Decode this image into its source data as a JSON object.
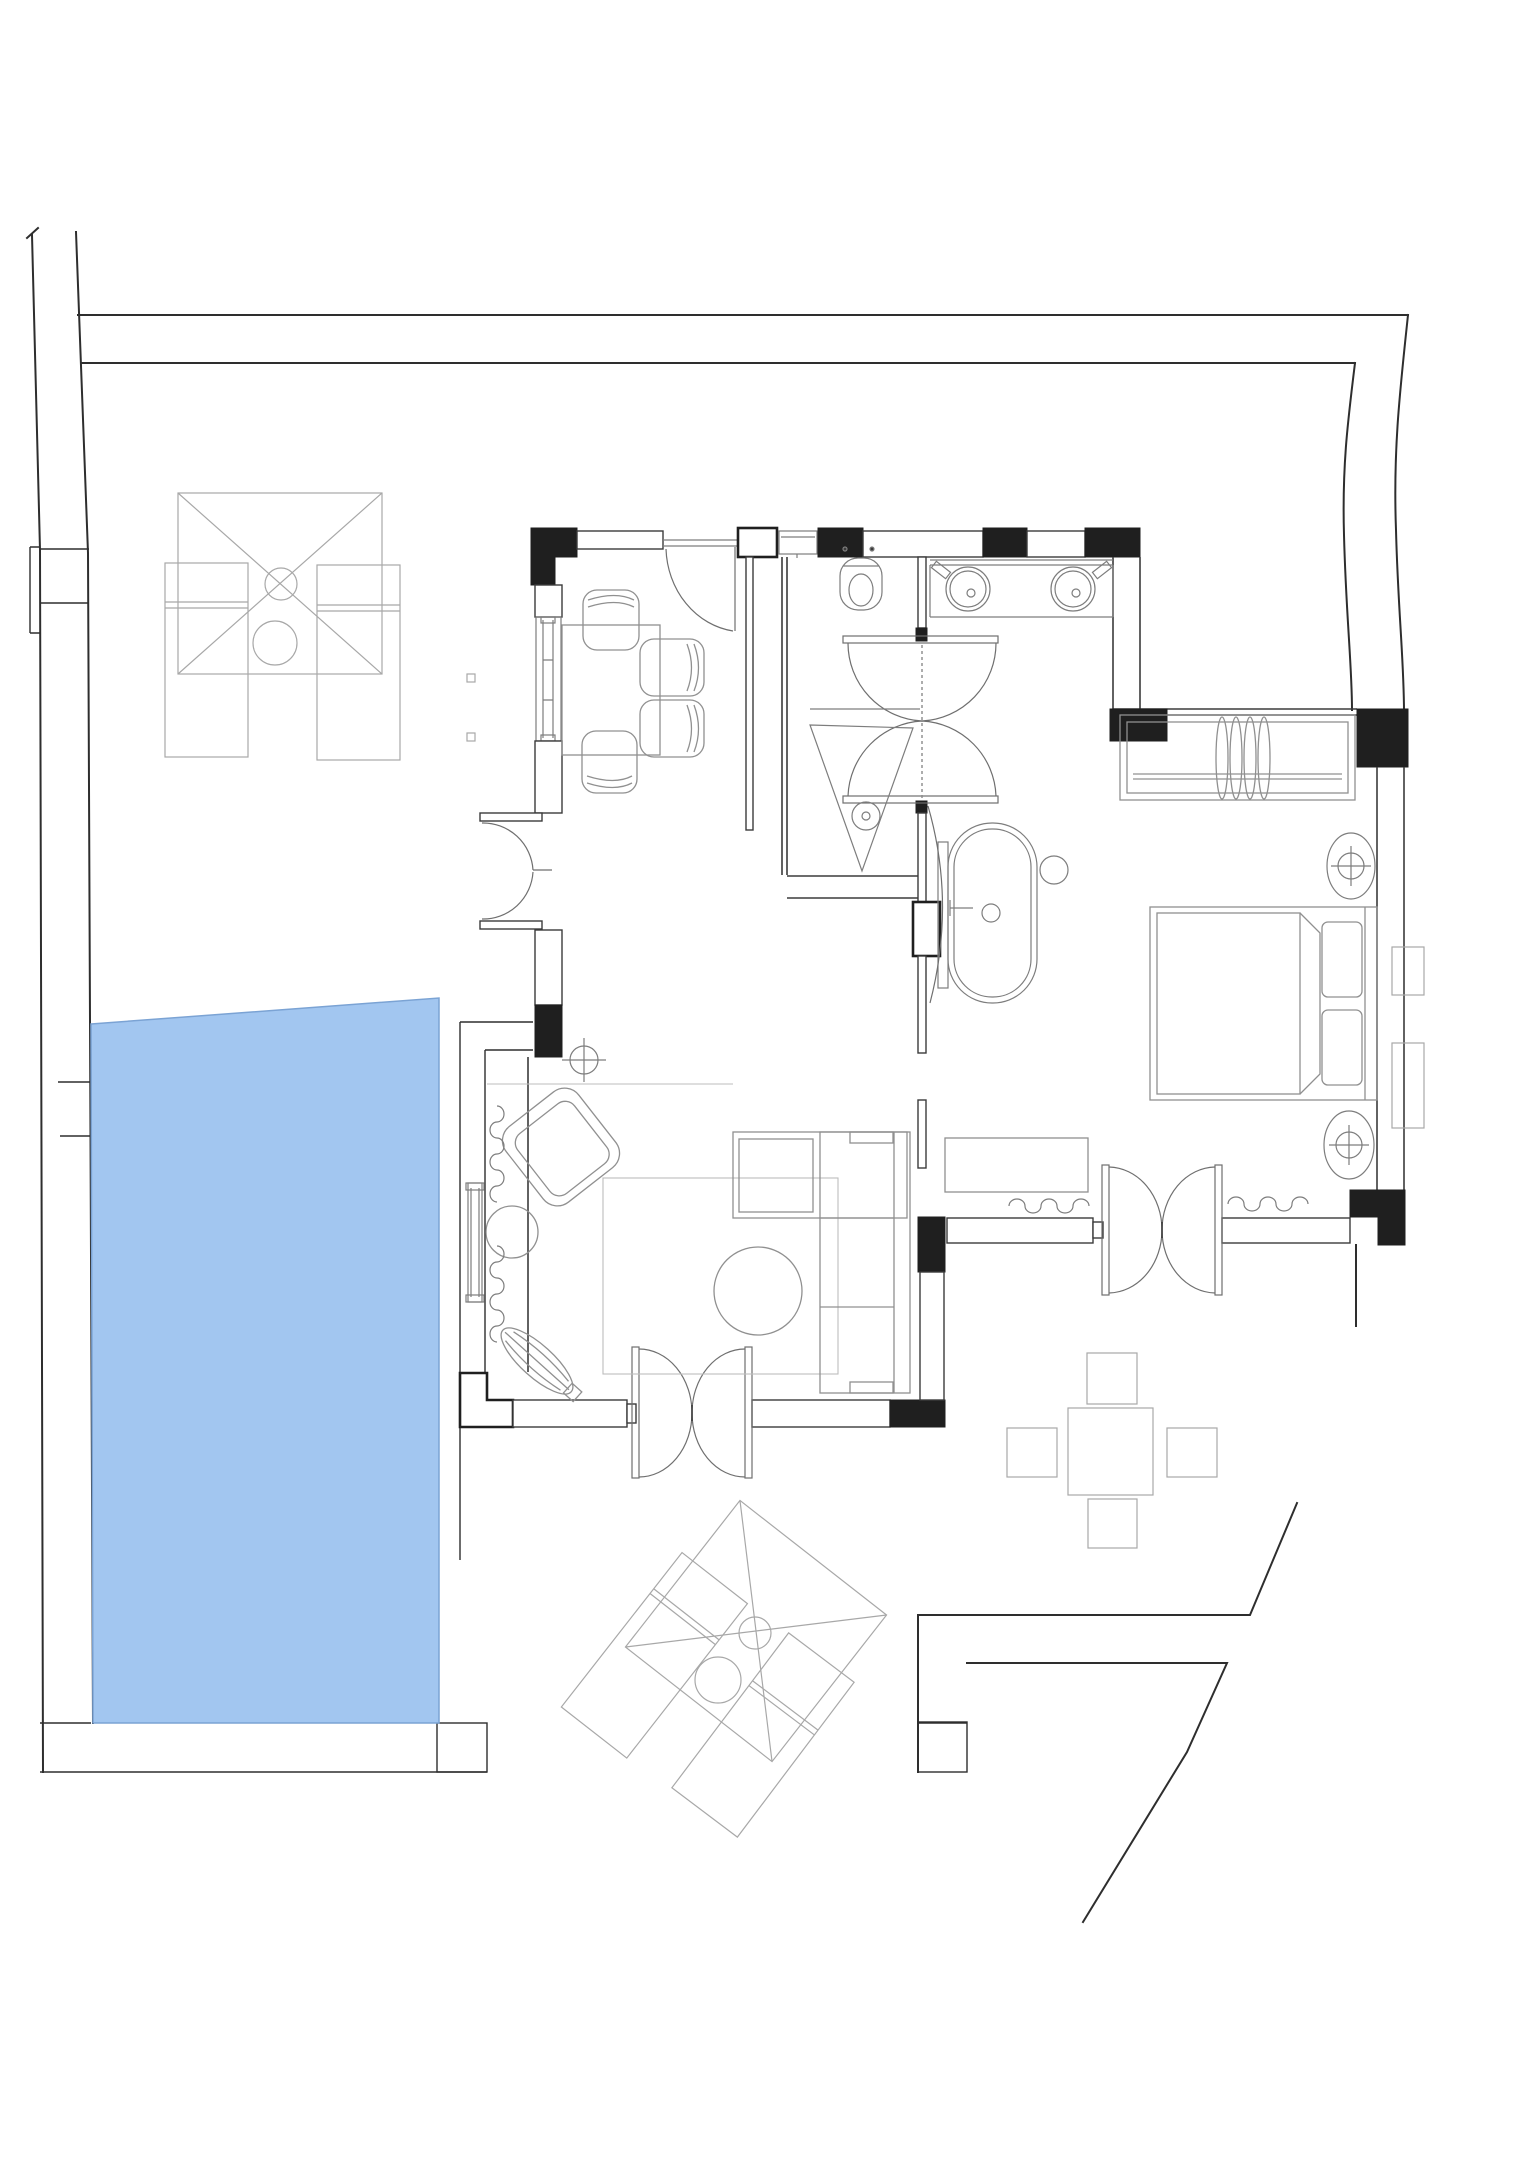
{
  "meta": {
    "description": "Architectural floor plan of a one-bedroom pool villa, top-down CAD line drawing with a blue swimming pool on the left and outdoor terrace furniture",
    "drawing_type": "floor-plan",
    "visible_text": []
  },
  "colors": {
    "bg": "#ffffff",
    "boundary": "#2e2e2e",
    "wall": "#3b3b3b",
    "pillar": "#1f1f1f",
    "door": "#6f6f6f",
    "fixture": "#7d7d7d",
    "furniture": "#909090",
    "outdoor": "#a8a8a8",
    "pool-fill": "#a2c6f0",
    "pool-stroke": "#7ba3d4"
  },
  "rooms": [
    {
      "name": "dining-kitchen",
      "contents": [
        "dining-table",
        "dining-chairs-x4",
        "window-west"
      ]
    },
    {
      "name": "wc-shower-room",
      "contents": [
        "toilet",
        "cistern",
        "shower-drain-triangle",
        "swing-double-door"
      ]
    },
    {
      "name": "vanity-area",
      "contents": [
        "double-vanity",
        "round-sinks-x2",
        "faucets-x2"
      ]
    },
    {
      "name": "bath-area",
      "contents": [
        "freestanding-bathtub",
        "stool",
        "glass-screen"
      ]
    },
    {
      "name": "bedroom",
      "contents": [
        "double-bed",
        "pillows-x2",
        "wardrobe-with-hangers",
        "ceiling-lights-x2",
        "console",
        "curtains"
      ]
    },
    {
      "name": "living-room",
      "contents": [
        "l-shaped-sofa",
        "round-coffee-table",
        "armchair",
        "side-table",
        "plant",
        "rug",
        "curtains",
        "double-swing-door"
      ]
    },
    {
      "name": "pool-terrace",
      "contents": [
        "swimming-pool",
        "parasol-with-loungers-north",
        "parasol-with-loungers-south",
        "outdoor-dining-set"
      ]
    }
  ],
  "pool": {
    "shape": "rectangle",
    "fill": "#a2c6f0"
  },
  "furniture_counts": {
    "loungers": 4,
    "parasols": 2,
    "dining_chairs": 4,
    "outdoor_chairs": 4,
    "sinks": 2,
    "beds": 1,
    "sofas": 1
  }
}
